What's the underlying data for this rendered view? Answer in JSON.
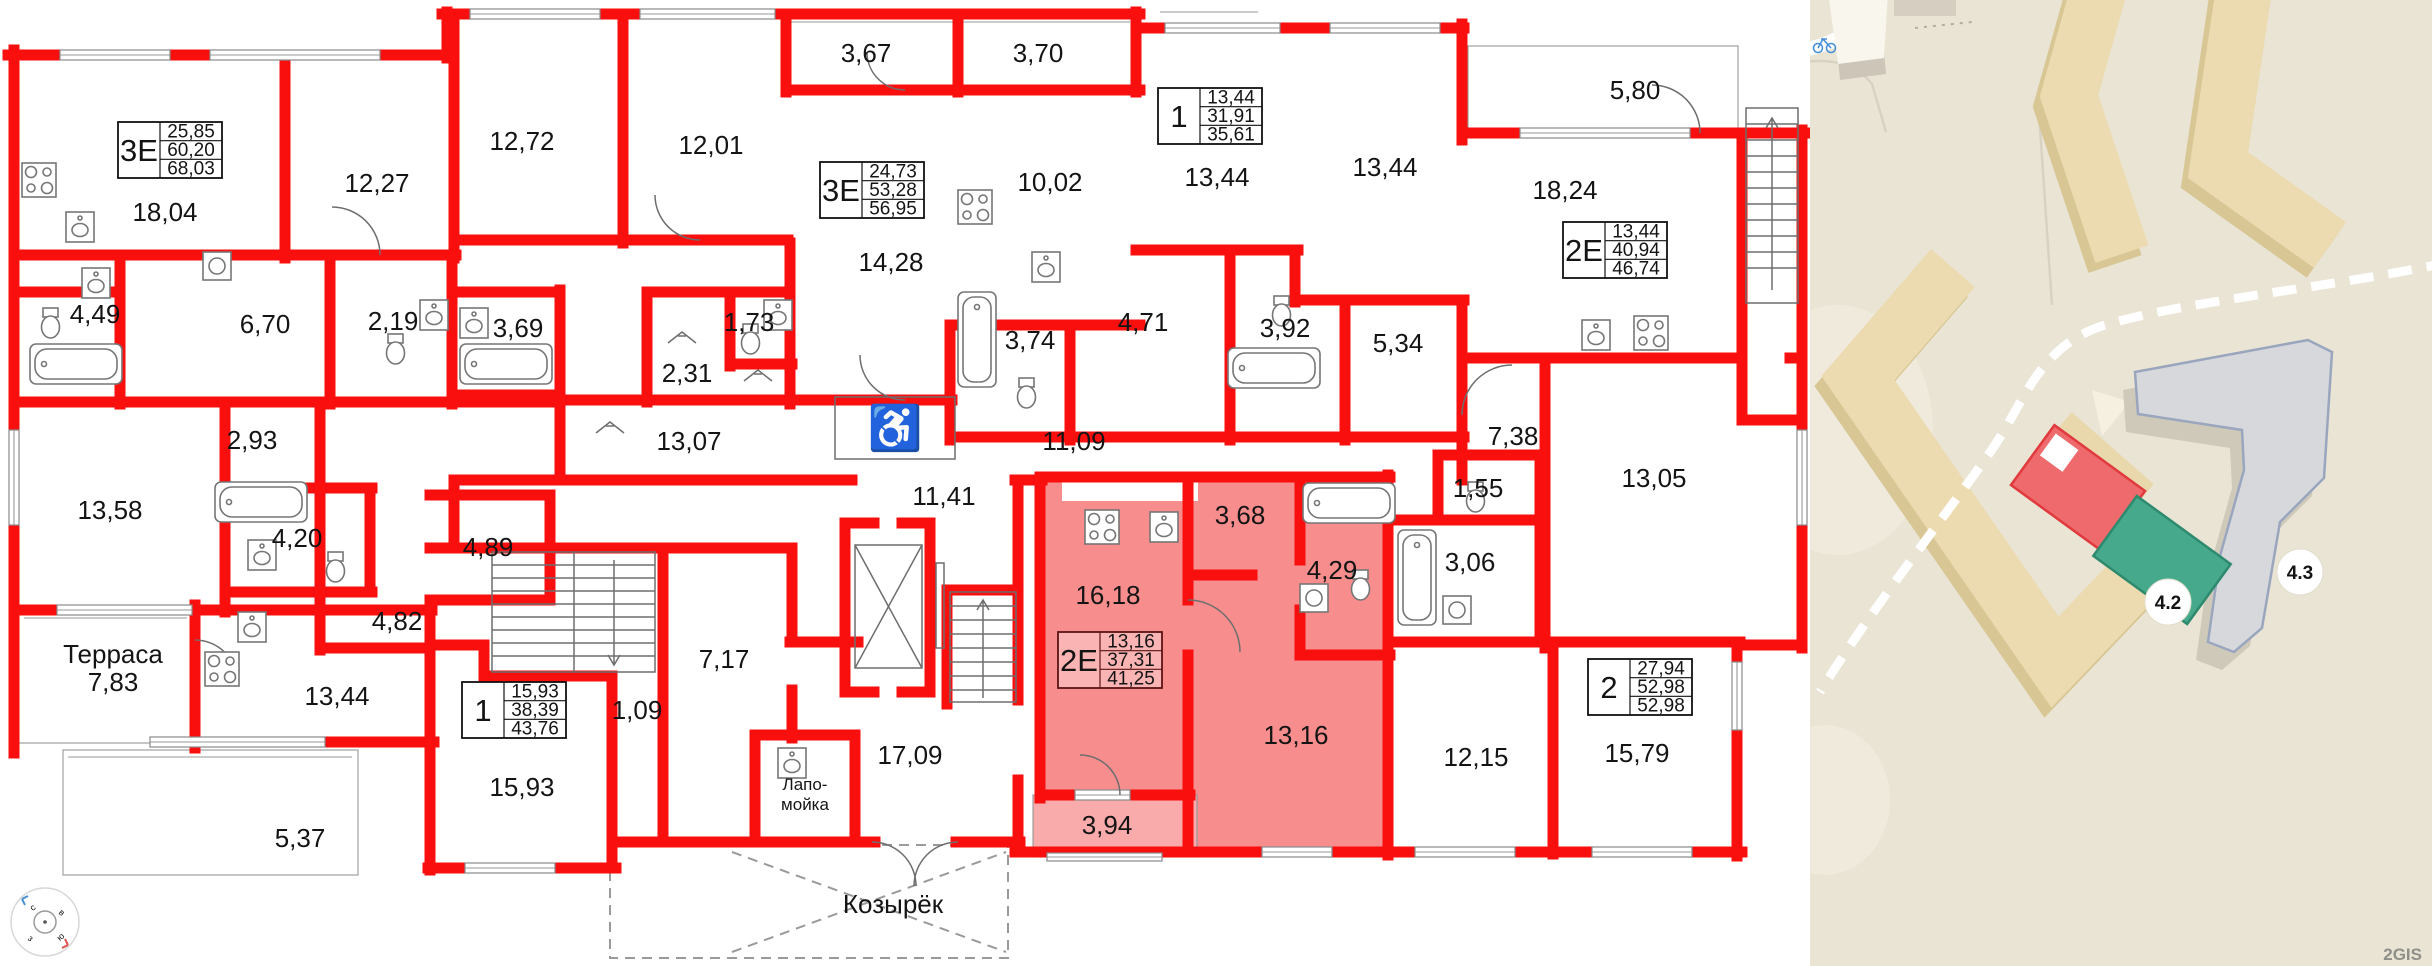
{
  "floorplan": {
    "apartment_cards": [
      {
        "id": "3e-top-left",
        "type": "3Е",
        "v1": "25,85",
        "v2": "60,20",
        "v3": "68,03"
      },
      {
        "id": "3e-top-mid",
        "type": "3Е",
        "v1": "24,73",
        "v2": "53,28",
        "v3": "56,95"
      },
      {
        "id": "1-top",
        "type": "1",
        "v1": "13,44",
        "v2": "31,91",
        "v3": "35,61"
      },
      {
        "id": "2e-right",
        "type": "2Е",
        "v1": "13,44",
        "v2": "40,94",
        "v3": "46,74"
      },
      {
        "id": "1-bottom",
        "type": "1",
        "v1": "15,93",
        "v2": "38,39",
        "v3": "43,76"
      },
      {
        "id": "2e-selected",
        "type": "2Е",
        "v1": "13,16",
        "v2": "37,31",
        "v3": "41,25"
      },
      {
        "id": "2-bottom-right",
        "type": "2",
        "v1": "27,94",
        "v2": "52,98",
        "v3": "52,98"
      }
    ],
    "rooms": {
      "a1804": "18,04",
      "a1227": "12,27",
      "a1272": "12,72",
      "a1201": "12,01",
      "a367": "3,67",
      "a370": "3,70",
      "a1428": "14,28",
      "a1002": "10,02",
      "a1344a": "13,44",
      "a1344b": "13,44",
      "a1824": "18,24",
      "a580": "5,80",
      "a449": "4,49",
      "a670": "6,70",
      "a219": "2,19",
      "a369": "3,69",
      "a231": "2,31",
      "a173": "1,73",
      "a374": "3,74",
      "a471": "4,71",
      "a392": "3,92",
      "a534": "5,34",
      "a293": "2,93",
      "a1307": "13,07",
      "a1109": "11,09",
      "a1141": "11,41",
      "a738": "7,38",
      "a155": "1,55",
      "a1305": "13,05",
      "a1358": "13,58",
      "a420": "4,20",
      "a489": "4,89",
      "a482": "4,82",
      "a368": "3,68",
      "a1618": "16,18",
      "a429": "4,29",
      "a306": "3,06",
      "a1344c": "13,44",
      "a1593": "15,93",
      "a109": "1,09",
      "a717": "7,17",
      "a1709": "17,09",
      "a1316": "13,16",
      "a394": "3,94",
      "a1215": "12,15",
      "a1579": "15,79",
      "a537": "5,37"
    },
    "annotations": {
      "terrace_name": "Терраса",
      "terrace_area": "7,83",
      "paw_wash_line1": "Лапо-",
      "paw_wash_line2": "мойка",
      "canopy": "Козырёк",
      "wheelchair_icon": "♿"
    },
    "colors": {
      "wall_red": "#f90f0d",
      "highlight": "#f78d8d",
      "highlight_light": "#f9aaaa"
    }
  },
  "map": {
    "badges": [
      {
        "label": "4.2"
      },
      {
        "label": "4.3"
      }
    ],
    "watermark": "2GIS",
    "colors": {
      "land": "#e9e4d4",
      "building_fill": "#ecdbb0",
      "building_shadow": "#d8c694",
      "highlight_red": "#ef6a6c",
      "highlight_green": "#47a98c",
      "neighbor_gray": "#d7d8dc",
      "neighbor_outline": "#99a6be"
    }
  }
}
